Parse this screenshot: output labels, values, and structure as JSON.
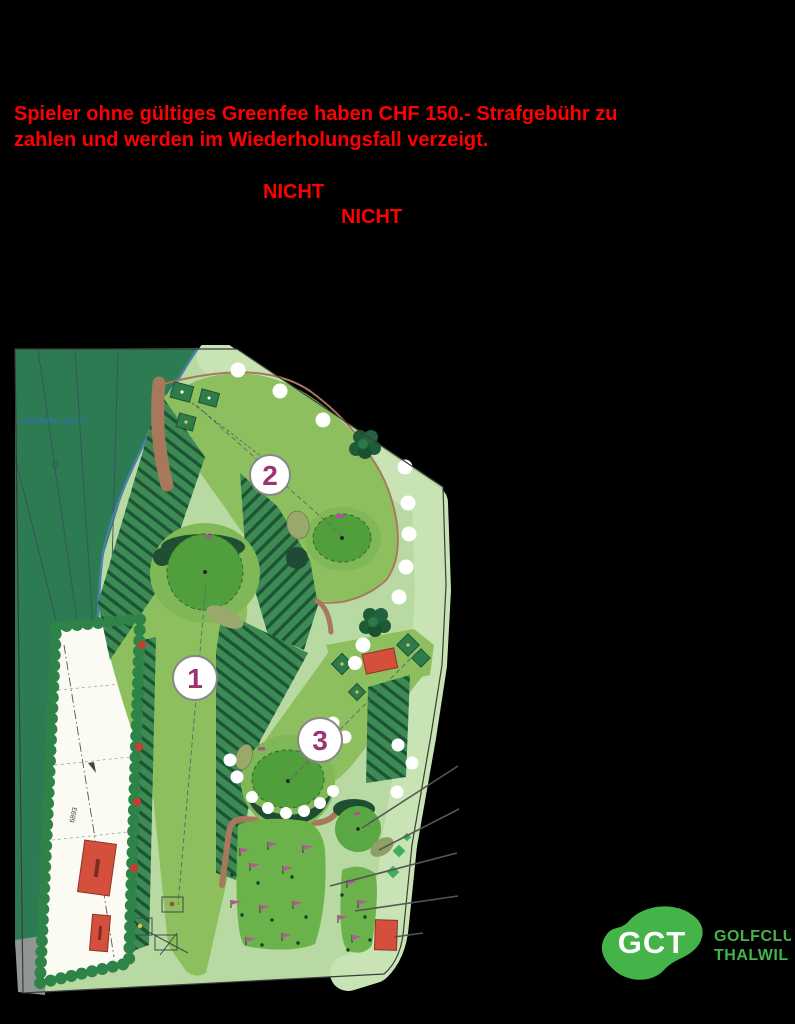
{
  "page": {
    "background": "#000000"
  },
  "warning": {
    "line1": "Spieler ohne gültiges Greenfee haben CHF 150.- Strafgebühr zu",
    "line2": "zahlen und werden im Wiederholungsfall verzeigt.",
    "color": "#ff0000"
  },
  "callouts": {
    "nicht1": "NICHT",
    "nicht2": "NICHT"
  },
  "map": {
    "type": "golf-course-site-plan",
    "fence_label": "Zaunhöhe: 12.7 m",
    "parcel_number": "6893",
    "hole_markers": {
      "h1": "1",
      "h2": "2",
      "h3": "3"
    },
    "colors": {
      "forest": "#2d7b52",
      "rough": "#b9d9a2",
      "outer_rough": "#c8e4b4",
      "fairway": "#8ebf5f",
      "green": "#519f3c",
      "fringe": "#80b857",
      "hatch_base": "#3d8a55",
      "hatch_line": "#1d5433",
      "path_brown": "#a7785c",
      "building_red": "#d4503c",
      "flag_magenta": "#b05a9a",
      "hole_number": "#9c3472",
      "hedge": "#2e8348",
      "survey_blue": "#2f6fb5"
    }
  },
  "logo": {
    "monogram": "GCT",
    "name_line1": "GOLFCLUB",
    "name_line2": "THALWIL",
    "green": "#44b449"
  }
}
